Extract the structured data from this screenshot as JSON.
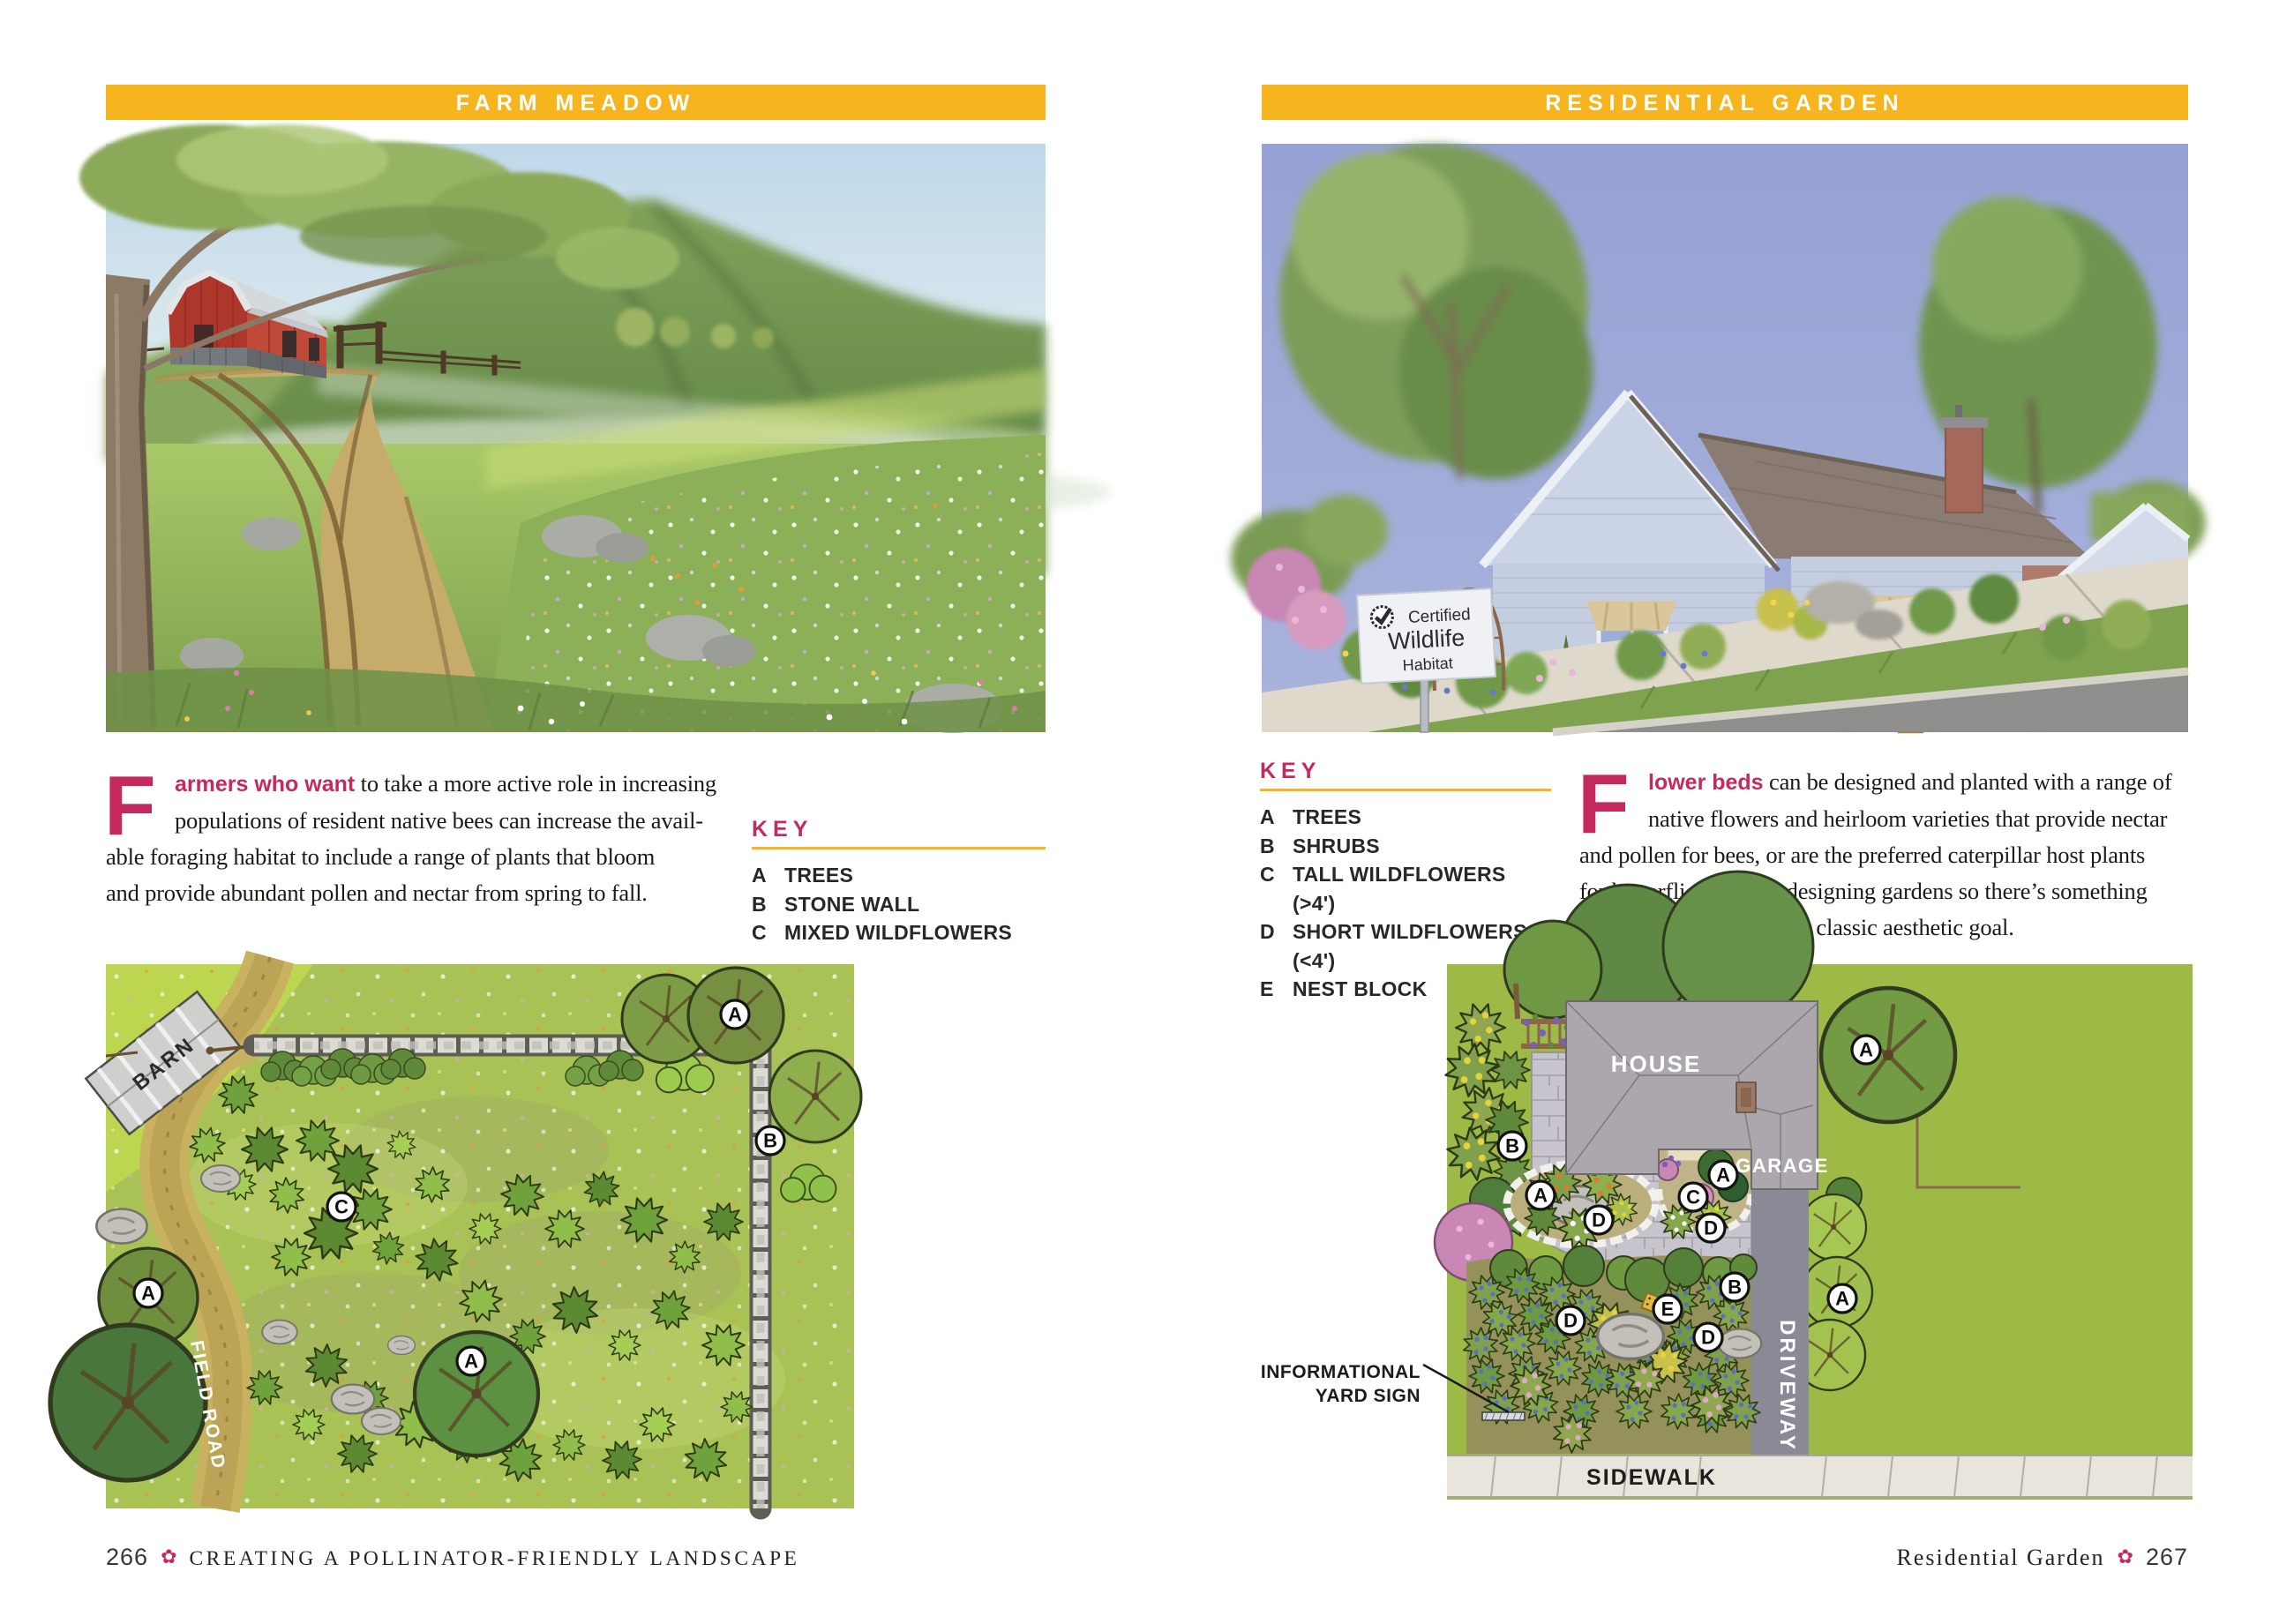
{
  "colors": {
    "accent_yellow": "#F6B41E",
    "accent_pink": "#C42A5E",
    "body_ink": "#1D1915"
  },
  "left_page": {
    "header": "FARM MEADOW",
    "paragraph": {
      "dropcap": "F",
      "lead": "armers who want",
      "line1_rest": " to take a more active role in increasing",
      "line2": "populations of resident native bees can increase the avail-",
      "line3": "able foraging habitat to include a range of plants that bloom",
      "line4": "and provide abundant pollen and nectar from spring to fall."
    },
    "key": {
      "title": "KEY",
      "items": [
        {
          "letter": "A",
          "label": "TREES"
        },
        {
          "letter": "B",
          "label": "STONE WALL"
        },
        {
          "letter": "C",
          "label": "MIXED WILDFLOWERS"
        }
      ]
    },
    "plan": {
      "barn_label": "BARN",
      "road_label": "FIELD ROAD",
      "markers": [
        {
          "letter": "A"
        },
        {
          "letter": "B"
        },
        {
          "letter": "C"
        },
        {
          "letter": "A"
        },
        {
          "letter": "A"
        }
      ]
    },
    "footer": {
      "page_number": "266",
      "flower_icon": "✿",
      "text": "CREATING A POLLINATOR-FRIENDLY LANDSCAPE"
    }
  },
  "right_page": {
    "header": "RESIDENTIAL GARDEN",
    "sign": {
      "line1": "Certified",
      "line2": "Wildlife",
      "line3": "Habitat"
    },
    "key": {
      "title": "KEY",
      "items": [
        {
          "letter": "A",
          "label": "TREES"
        },
        {
          "letter": "B",
          "label": "SHRUBS"
        },
        {
          "letter": "C",
          "label": "TALL WILDFLOWERS (>4')"
        },
        {
          "letter": "D",
          "label": "SHORT WILDFLOWERS (<4')"
        },
        {
          "letter": "E",
          "label": "NEST BLOCK"
        }
      ]
    },
    "paragraph": {
      "dropcap": "F",
      "lead": "lower beds",
      "line1_rest": " can be designed and planted with a range of",
      "line2": "native flowers and heirloom varieties that provide nectar",
      "line3": "and pollen for bees, or are the preferred caterpillar host plants",
      "line4": "for butterflies. In fact, designing gardens so there’s something",
      "line5": "blooming at all times is a classic aesthetic goal."
    },
    "annotation": {
      "line1": "INFORMATIONAL",
      "line2": "YARD SIGN"
    },
    "plan": {
      "house_label": "HOUSE",
      "garage_label": "GARAGE",
      "driveway_label": "DRIVEWAY",
      "sidewalk_label": "SIDEWALK",
      "markers": [
        {
          "letter": "A"
        },
        {
          "letter": "B"
        },
        {
          "letter": "A"
        },
        {
          "letter": "D"
        },
        {
          "letter": "A"
        },
        {
          "letter": "C"
        },
        {
          "letter": "D"
        },
        {
          "letter": "B"
        },
        {
          "letter": "E"
        },
        {
          "letter": "D"
        },
        {
          "letter": "D"
        },
        {
          "letter": "A"
        }
      ]
    },
    "footer": {
      "text": "Residential Garden",
      "flower_icon": "✿",
      "page_number": "267"
    }
  }
}
